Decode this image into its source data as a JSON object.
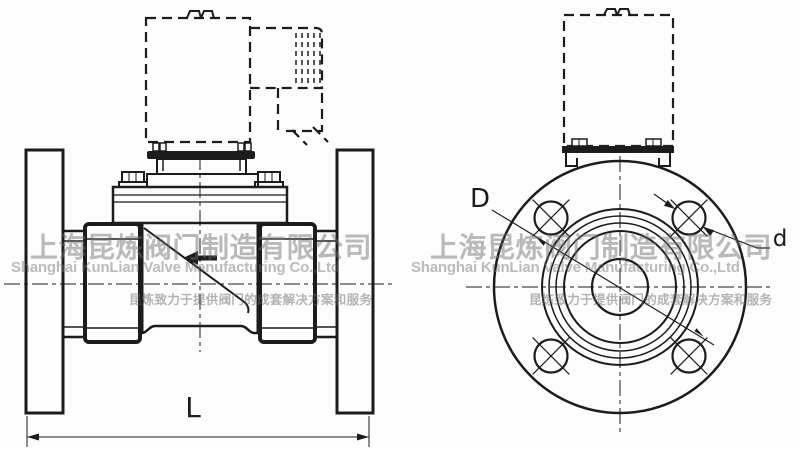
{
  "labels": {
    "length_dim": "L",
    "bolt_circle_dim": "D",
    "bolt_hole_dim": "d"
  },
  "watermark": {
    "company_cn": "上海昆炼阀门制造有限公司",
    "company_en": "Shanghai KunLian Valve Manufacturing Co.,Ltd",
    "slogan_cn": "昆炼致力于提供阀门的成套解决方案和服务"
  },
  "colors": {
    "line": "#1c1c1c",
    "background": "#fdfdfd",
    "watermark_gray": "#c3c3c3"
  }
}
